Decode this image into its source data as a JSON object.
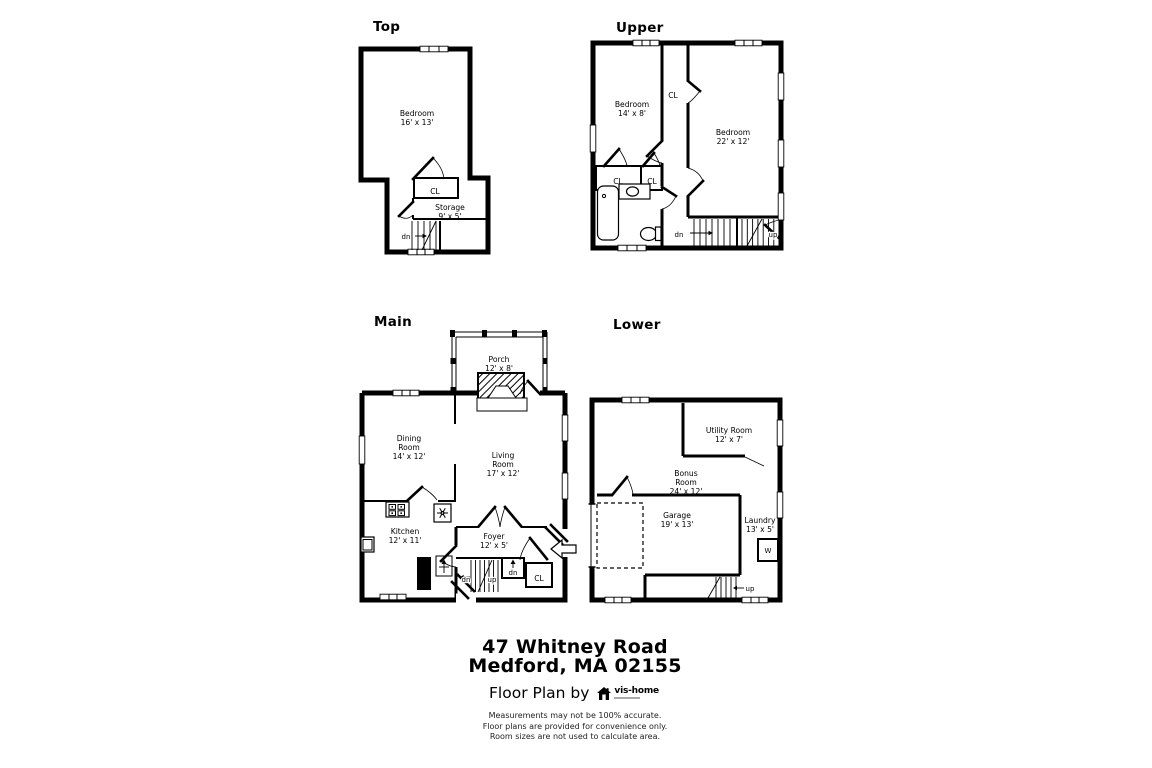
{
  "floors": {
    "top": {
      "title": "Top",
      "rooms": {
        "bedroom": {
          "lines": [
            "Bedroom",
            "16' x 13'"
          ]
        },
        "storage": {
          "lines": [
            "Storage",
            "9' x 5'"
          ]
        },
        "closet": "CL"
      },
      "stairs": {
        "dn": "dn"
      }
    },
    "upper": {
      "title": "Upper",
      "rooms": {
        "bedroom_left": {
          "lines": [
            "Bedroom",
            "14' x 8'"
          ]
        },
        "bedroom_right": {
          "lines": [
            "Bedroom",
            "22' x 12'"
          ]
        },
        "hall_closet": "CL",
        "closet_left": "CL",
        "closet_right": "CL"
      },
      "stairs": {
        "dn": "dn",
        "up": "up"
      }
    },
    "main": {
      "title": "Main",
      "rooms": {
        "porch": {
          "lines": [
            "Porch",
            "12' x 8'"
          ]
        },
        "dining": {
          "lines": [
            "Dining",
            "Room",
            "14' x 12'"
          ]
        },
        "living": {
          "lines": [
            "Living",
            "Room",
            "17' x 12'"
          ]
        },
        "kitchen": {
          "lines": [
            "Kitchen",
            "12' x 11'"
          ]
        },
        "foyer": {
          "lines": [
            "Foyer",
            "12' x 5'"
          ]
        },
        "closet": "CL"
      },
      "stairs": {
        "dn": "dn",
        "up": "up",
        "landing_dn": "dn"
      }
    },
    "lower": {
      "title": "Lower",
      "rooms": {
        "utility": {
          "lines": [
            "Utility Room",
            "12' x 7'"
          ]
        },
        "bonus": {
          "lines": [
            "Bonus",
            "Room",
            "24' x 12'"
          ]
        },
        "garage": {
          "lines": [
            "Garage",
            "19' x 13'"
          ]
        },
        "laundry": {
          "lines": [
            "Laundry",
            "13' x 5'"
          ]
        },
        "washer": "W"
      },
      "stairs": {
        "up": "up"
      }
    }
  },
  "footer": {
    "address_line1": "47 Whitney Road",
    "address_line2": "Medford, MA 02155",
    "credit": "Floor Plan by",
    "brand": "vis-home",
    "disclaimer": [
      "Measurements may not be 100% accurate.",
      "Floor plans are provided for convenience only.",
      "Room sizes are not used to calculate area."
    ]
  },
  "colors": {
    "ink": "#000000",
    "paper": "#ffffff"
  }
}
